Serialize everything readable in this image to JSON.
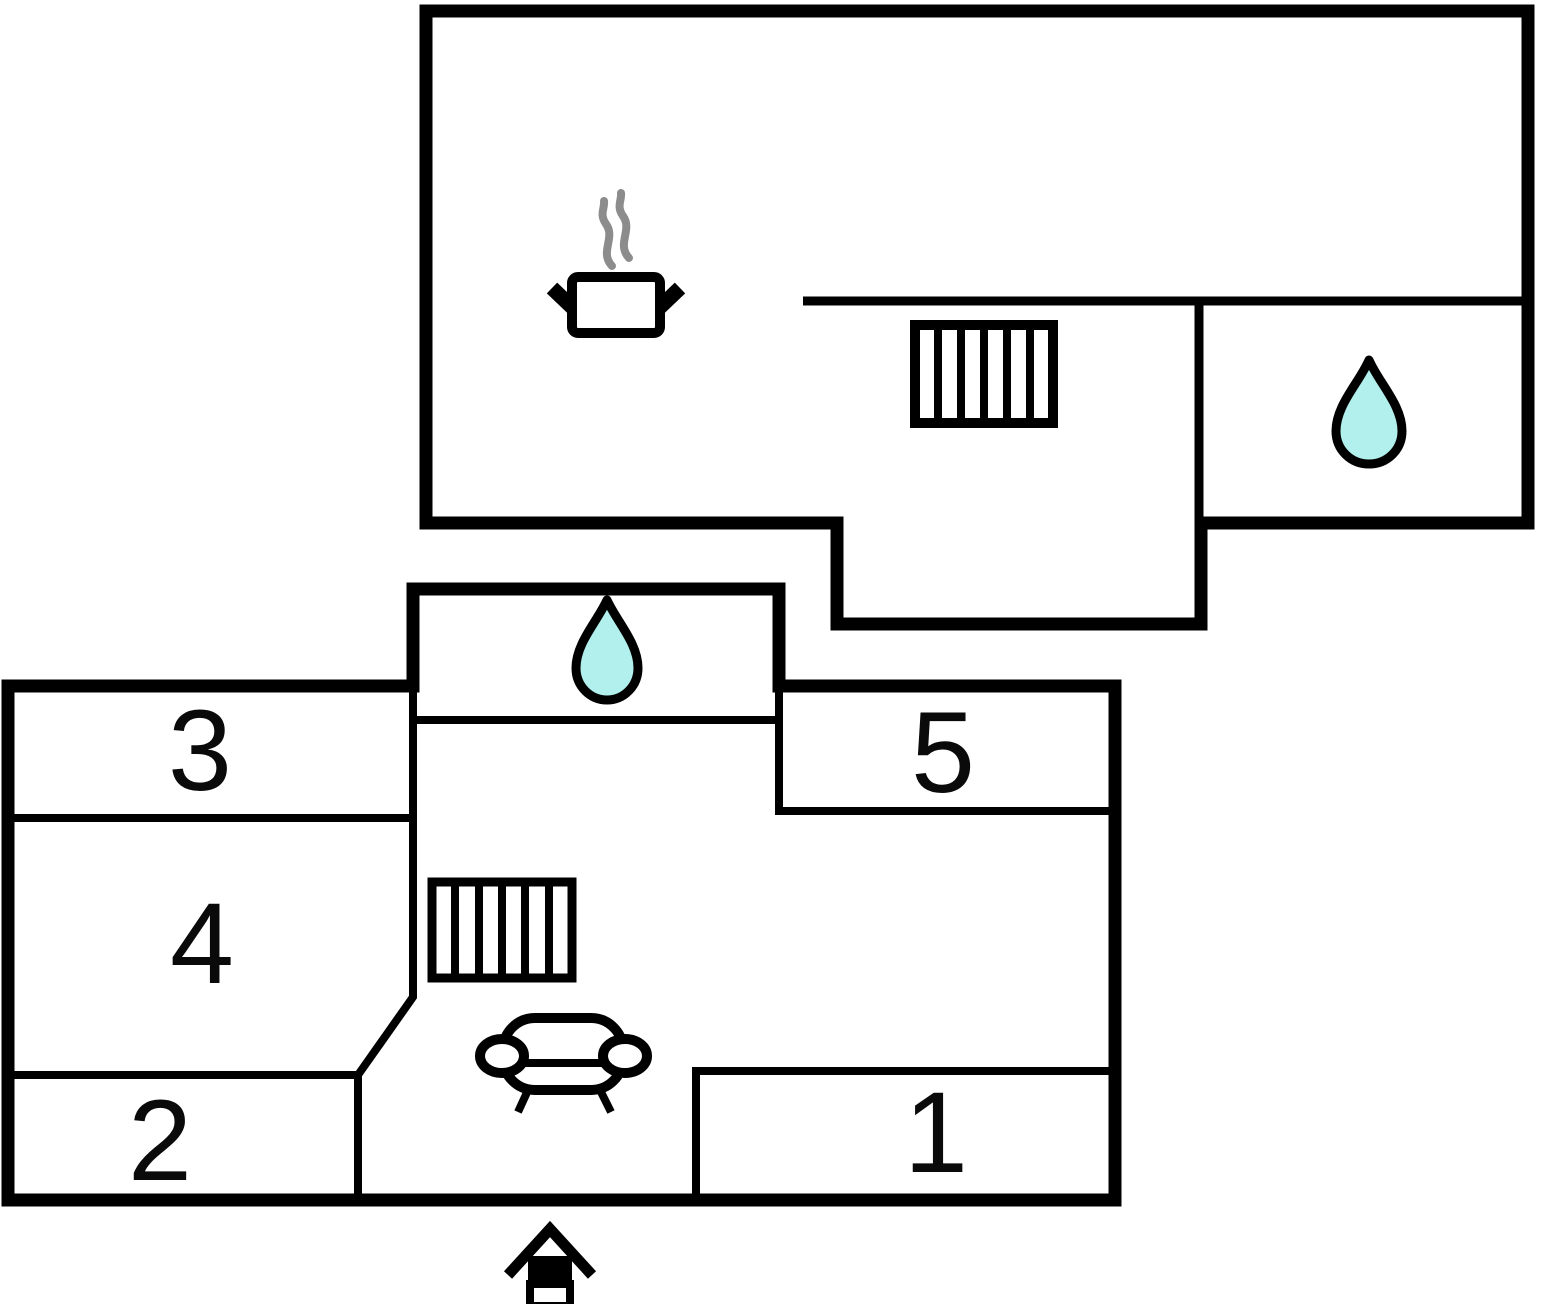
{
  "floorplan": {
    "room_labels": {
      "r1": "1",
      "r2": "2",
      "r3": "3",
      "r4": "4",
      "r5": "5"
    },
    "icons": {
      "upper_bathroom": "water-drop-icon",
      "lower_bathroom": "water-drop-icon",
      "kitchen": "pot-with-steam-icon",
      "upper_stairs": "stairs-icon",
      "lower_stairs": "stairs-icon",
      "living_area": "sofa-icon",
      "entrance": "entrance-arrow-icon"
    },
    "colors": {
      "wall": "#000000",
      "background": "#ffffff",
      "water_fill": "#b2f0ee",
      "steam": "#8c8c8c"
    }
  }
}
